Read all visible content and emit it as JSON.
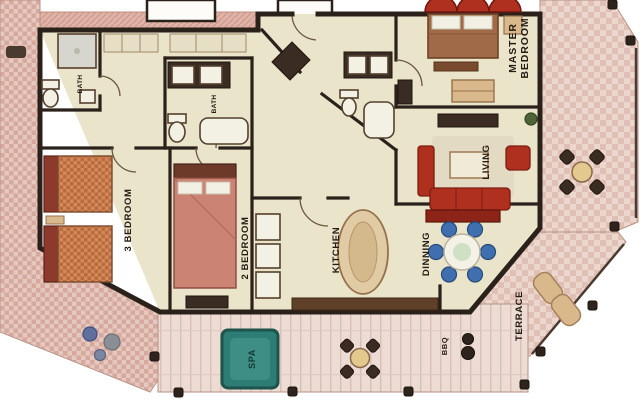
{
  "figure": {
    "type": "floor-plan"
  },
  "rooms": {
    "master_bedroom": {
      "line1": "MASTER",
      "line2": "BEDROOM"
    },
    "living": {
      "label": "LIVING"
    },
    "dinning": {
      "label": "DINNING"
    },
    "kitchen": {
      "label": "KITCHEN"
    },
    "bedroom2": {
      "label": "2 BEDROOM"
    },
    "bedroom3": {
      "label": "3 BEDROOM"
    },
    "terrace": {
      "label": "TERRACE"
    },
    "bbq": {
      "label": "BBQ"
    },
    "spa": {
      "label": "SPA"
    },
    "bath_left": {
      "label": "BATH"
    },
    "bath_middle": {
      "label": "BATH"
    }
  },
  "icons": [
    "bed-icon",
    "sofa-icon",
    "armchair-icon",
    "dining-table-icon",
    "kitchen-island-icon",
    "spa-icon",
    "bbq-grill-icon",
    "patio-table-icon",
    "lounge-chair-icon",
    "toilet-icon",
    "shower-icon",
    "bathtub-icon",
    "double-sink-icon",
    "plant-icon",
    "post-icon"
  ],
  "colors": {
    "wall": "#2b211b",
    "floor": "#eae4cb",
    "deck": "#e5c8bf",
    "deck_alt": "#d7a99d",
    "terrace": "#ecd7ce",
    "terrace_alt": "#e0c0b4",
    "porch": "#ecdcd4",
    "red": "#b0301f",
    "red_dark": "#8d2418",
    "wood_dark": "#5f4028",
    "tan": "#d9b98c",
    "blue_chair": "#3f6fae",
    "spa": "#2e7d74",
    "spa_inner": "#3f8e85",
    "label": "#241b13"
  }
}
